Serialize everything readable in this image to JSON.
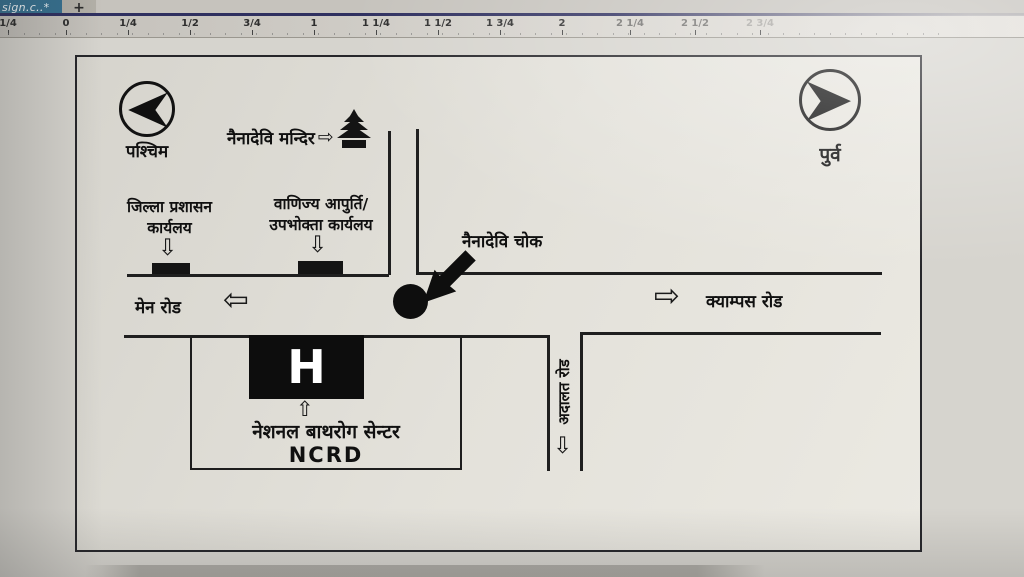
{
  "window": {
    "tab_title": "sign.c..*",
    "new_tab_label": "+"
  },
  "ruler": {
    "unit_labels": [
      {
        "text": "1/4",
        "x": 8
      },
      {
        "text": "0",
        "x": 66
      },
      {
        "text": "1/4",
        "x": 128
      },
      {
        "text": "1/2",
        "x": 190
      },
      {
        "text": "3/4",
        "x": 252
      },
      {
        "text": "1",
        "x": 314
      },
      {
        "text": "1 1/4",
        "x": 376
      },
      {
        "text": "1 1/2",
        "x": 438
      },
      {
        "text": "1 3/4",
        "x": 500
      },
      {
        "text": "2",
        "x": 562
      },
      {
        "text": "2 1/4",
        "x": 630
      },
      {
        "text": "2 1/2",
        "x": 695
      },
      {
        "text": "2 3/4",
        "x": 760
      }
    ]
  },
  "map": {
    "compass": {
      "west_label": "पश्चिम",
      "east_label": "पुर्व"
    },
    "temple": {
      "label": "नैनादेवि मन्दिर",
      "arrow": "⇨"
    },
    "offices": [
      {
        "line1": "जिल्ला प्रशासन",
        "line2": "कार्यलय",
        "arrow": "⇩"
      },
      {
        "line1": "वाणिज्य आपुर्ति/",
        "line2": "उपभोक्ता कार्यलय",
        "arrow": "⇩"
      }
    ],
    "chowk": {
      "label": "नैनादेवि चोक"
    },
    "roads": {
      "main_road": {
        "label": "मेन रोड",
        "arrow": "⇦"
      },
      "campus_road": {
        "label": "क्याम्पस रोड",
        "arrow": "⇨"
      },
      "court_road": {
        "label": "अदालत रोड",
        "arrow": "⇩"
      }
    },
    "building": {
      "h_label": "H",
      "arrow": "⇧",
      "name_line1": "नेशनल बाथरोग सेन्टर",
      "name_line2": "NCRD"
    }
  },
  "colors": {
    "tab_blue": "#36708f",
    "underline_navy": "#2f3060",
    "ink": "#1f1f1f",
    "canvas_gray": "#d6d4ce",
    "map_paper": "#e3e1da"
  }
}
